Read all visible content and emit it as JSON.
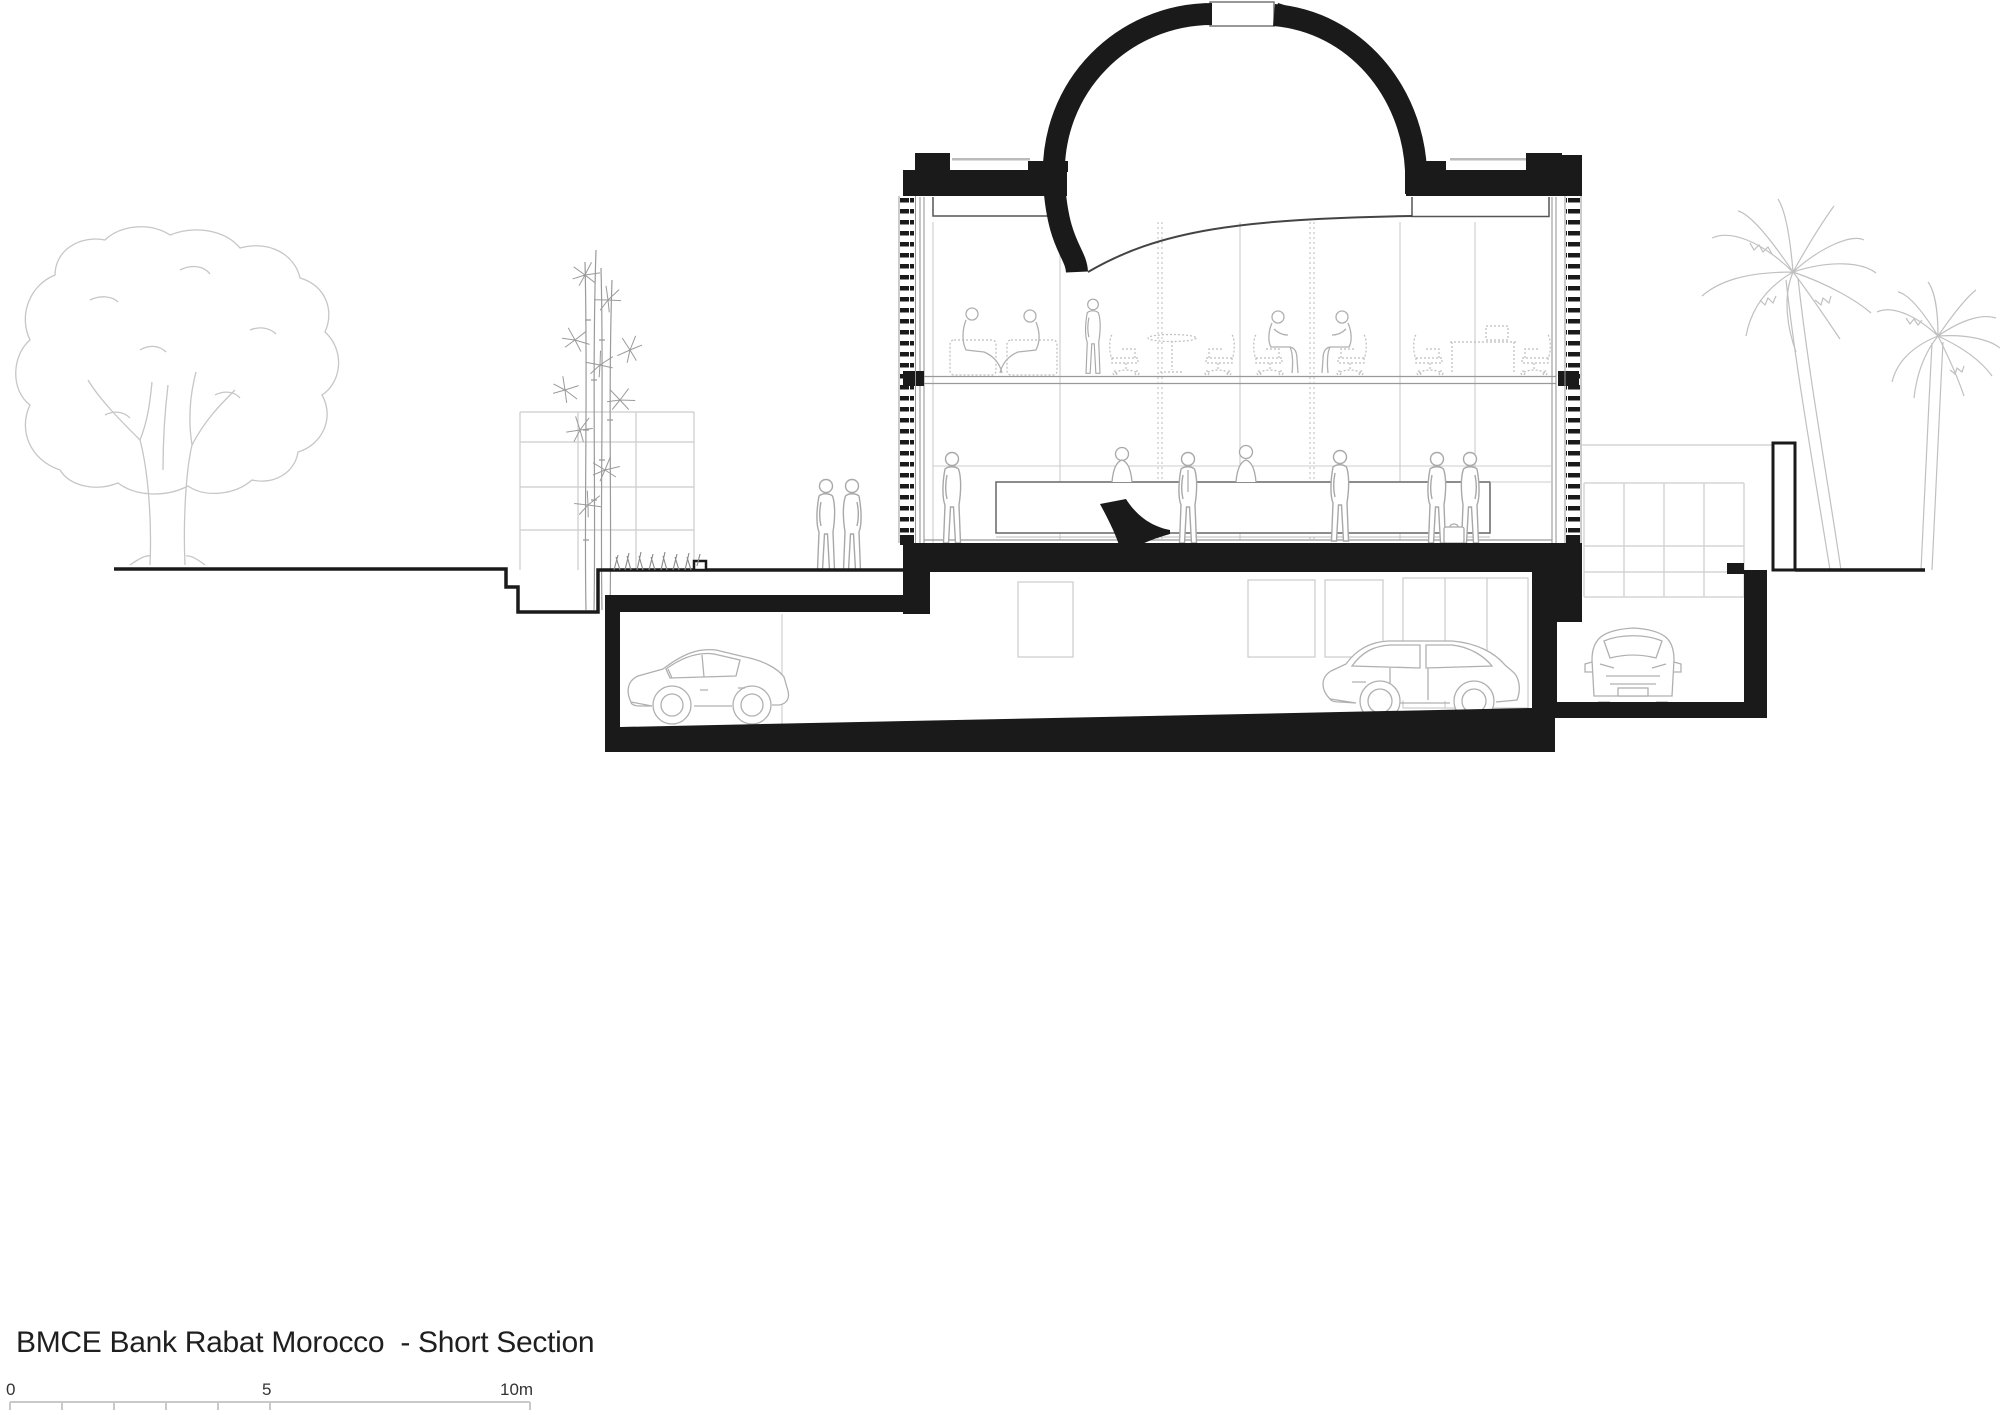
{
  "title": "BMCE Bank Rabat Morocco  - Short Section",
  "scale_bar": {
    "start_label": "0",
    "mid_label": "5",
    "end_label": "10m"
  },
  "colors": {
    "ink": "#1a1a1a",
    "light_figure_line": "#a8a8a8",
    "faint_line": "#cccccc",
    "vegetation_line": "#c6c6c6",
    "text": "#1f1f1f"
  }
}
